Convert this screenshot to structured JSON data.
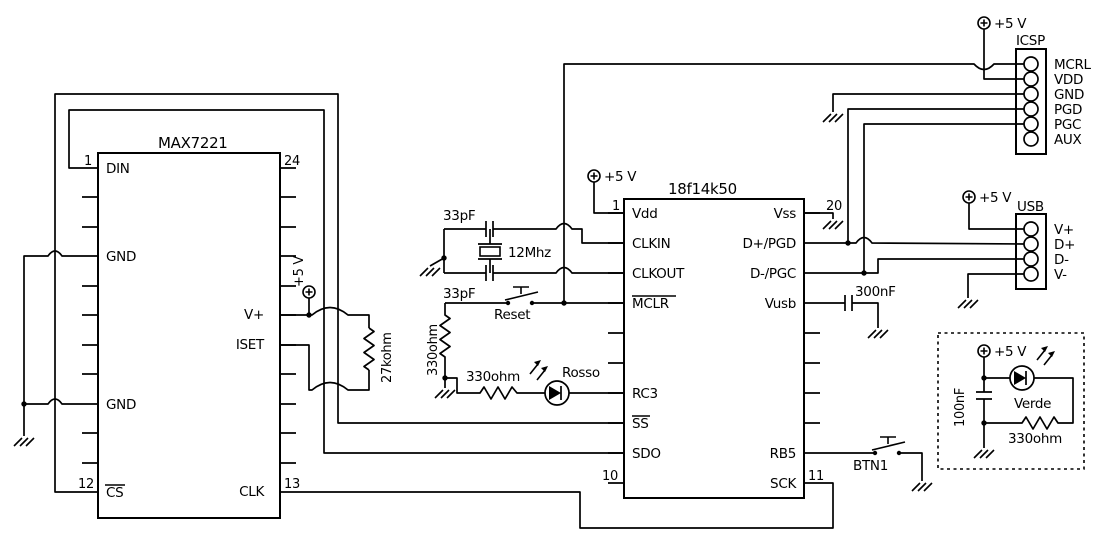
{
  "max7221": {
    "title": "MAX7221",
    "pin_numbers": {
      "top_left": "1",
      "top_right": "24",
      "bottom_left": "12",
      "bottom_right": "13"
    },
    "pins": {
      "din": "DIN",
      "gnd_upper": "GND",
      "gnd_lower": "GND",
      "cs": "CS",
      "vplus": "V+",
      "iset": "ISET",
      "clk": "CLK"
    }
  },
  "pic18f14k50": {
    "title": "18f14k50",
    "pin_numbers": {
      "top_left": "1",
      "top_right": "20",
      "bottom_left": "10",
      "bottom_right": "11"
    },
    "left_pins": {
      "vdd": "Vdd",
      "clkin": "CLKIN",
      "clkout": "CLKOUT",
      "mclr": "MCLR",
      "rc3": "RC3",
      "ss": "SS",
      "sdo": "SDO"
    },
    "right_pins": {
      "vss": "Vss",
      "d_plus_pgd": "D+/PGD",
      "d_minus_pgc": "D-/PGC",
      "vusb": "Vusb",
      "rb5": "RB5",
      "sck": "SCK"
    }
  },
  "icsp": {
    "title": "ICSP",
    "pins": [
      "MCRL",
      "VDD",
      "GND",
      "PGD",
      "PGC",
      "AUX"
    ]
  },
  "usb": {
    "title": "USB",
    "pins": [
      "V+",
      "D+",
      "D-",
      "V-"
    ]
  },
  "components": {
    "cap_top": "33pF",
    "cap_bottom": "33pF",
    "crystal": "12Mhz",
    "reset_button": "Reset",
    "mclr_resistor": "330ohm",
    "rosso_resistor": "330ohm",
    "rosso_led": "Rosso",
    "iset_resistor": "27kohm",
    "vusb_capacitor": "300nF",
    "btn1": "BTN1",
    "verde_led": "Verde",
    "verde_resistor": "330ohm",
    "verde_capacitor": "100nF"
  },
  "power": {
    "plus5v": "+5 V"
  },
  "colors": {
    "wire": "#000000",
    "background": "#ffffff"
  }
}
